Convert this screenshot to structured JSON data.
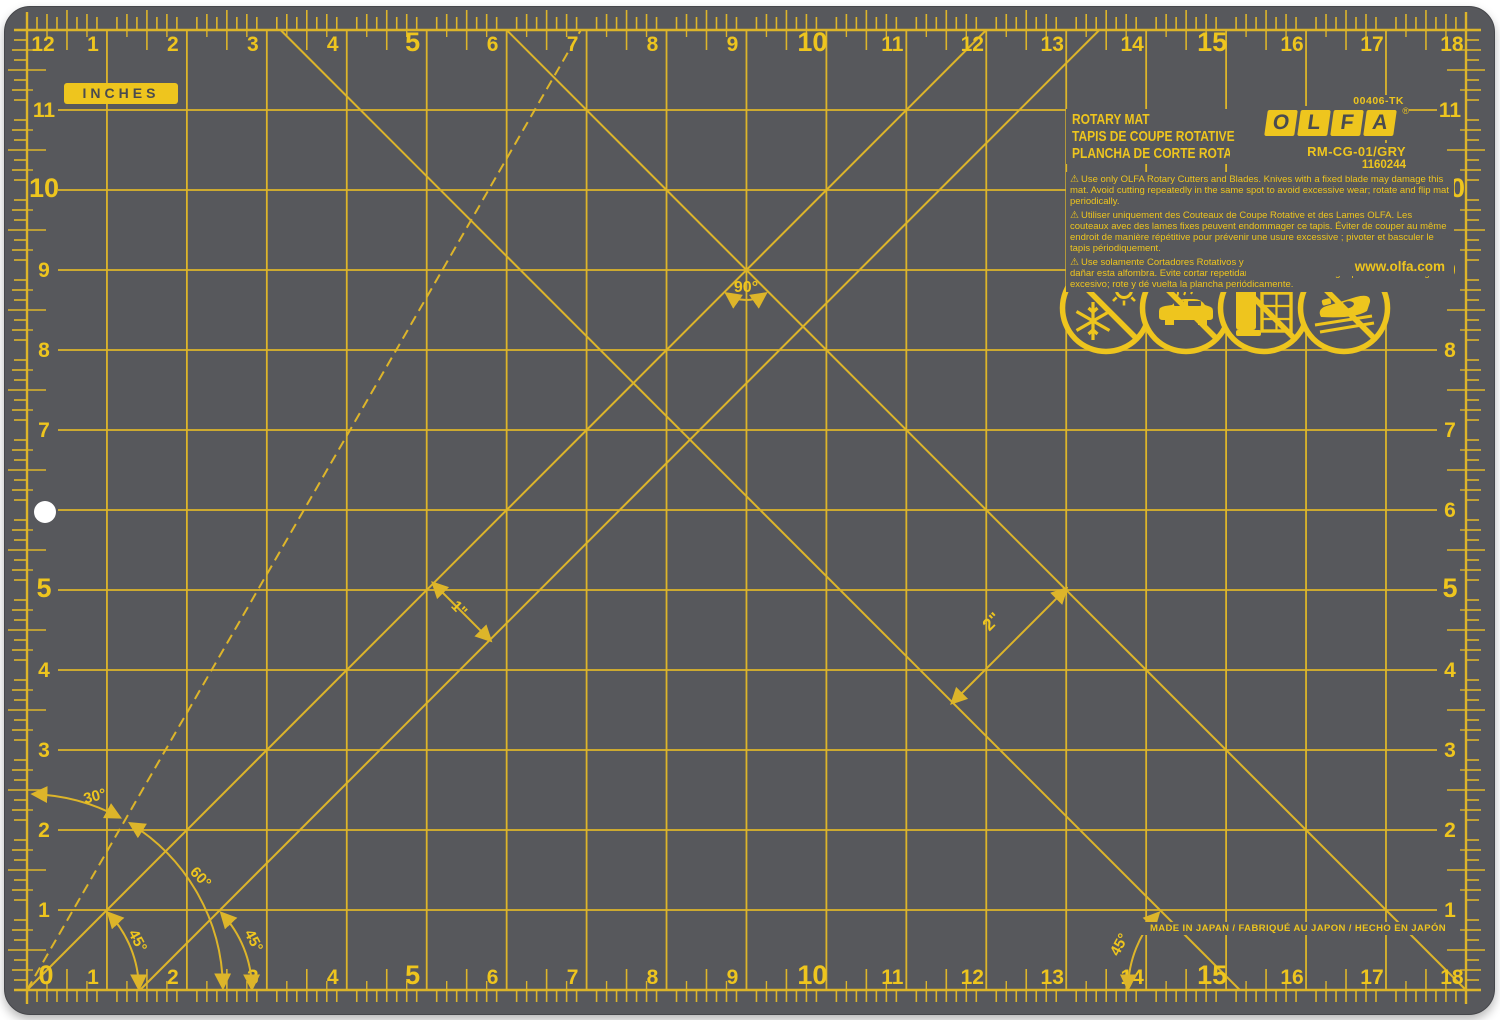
{
  "colors": {
    "mat": "#57585c",
    "line": "#ddb52a",
    "number": "#eec51e",
    "bright": "#f2ce1b",
    "dark": "#4a4b4f",
    "page": "#ffffff"
  },
  "badge": {
    "label": "INCHES"
  },
  "branding": {
    "part_code": "00406-TK",
    "title_en": "ROTARY MAT",
    "title_fr": "TAPIS DE COUPE ROTATIVE",
    "title_es": "PLANCHA DE CORTE ROTATIVA",
    "logo_letters": [
      "O",
      "L",
      "F",
      "A"
    ],
    "registered": "®",
    "model_code": "RM-CG-01/GRY",
    "item_number": "1160244",
    "website": "www.olfa.com",
    "made_in": "MADE IN JAPAN / FABRIQUÉ AU JAPON / HECHO EN JAPÓN"
  },
  "warnings": {
    "symbol": "⚠",
    "en": "Use only OLFA Rotary Cutters and Blades. Knives with a fixed blade may damage this mat. Avoid cutting repeatedly in the same spot to avoid excessive wear; rotate and flip mat periodically.",
    "fr": "Utiliser uniquement des Couteaux de Coupe Rotative et des Lames OLFA. Les couteaux avec des lames fixes peuvent endommager ce tapis. Éviter de couper au même endroit de manière répétitive pour prévenir une usure excessive ; pivoter et basculer le tapis périodiquement.",
    "es": "Use solamente Cortadores Rotativos y Hojas OLFA. Cuchillos con hojas fijas podrían dañar esta alfombra. Evite cortar repetidamente en el mismo lugar para evitar el desgaste excesivo; rote y dé vuelta la plancha periódicamente."
  },
  "angles": {
    "a90": "90°",
    "a30": "30°",
    "a60": "60°",
    "a45_left_inner": "45°",
    "a45_left_outer": "45°",
    "a45_right": "45°"
  },
  "dimensions": {
    "one_inch": "1\"",
    "two_inch": "2\""
  },
  "grid": {
    "x0": 27,
    "dx": 79.94,
    "y0": 990,
    "dy": 80,
    "unit": "inch",
    "cols": 18,
    "rows": 12
  },
  "hole": {
    "cx": 45,
    "cy": 512,
    "r": 11
  },
  "diagonals": [
    {
      "name": "diagonal-45-rising",
      "from": [
        0,
        0
      ],
      "to": [
        12,
        12
      ],
      "dashed": false
    },
    {
      "name": "diagonal-45-rising-offset-1in",
      "from": [
        1.414,
        0
      ],
      "to": [
        13.414,
        12
      ],
      "dashed": false
    },
    {
      "name": "diagonal-45-falling",
      "from": [
        6,
        12
      ],
      "to": [
        18,
        0
      ],
      "dashed": false
    },
    {
      "name": "diagonal-45-falling-offset-2in",
      "from": [
        3.172,
        12
      ],
      "to": [
        15.172,
        0
      ],
      "dashed": false
    },
    {
      "name": "diagonal-60-dashed",
      "from": [
        0,
        0
      ],
      "to": [
        6.928,
        12
      ],
      "dashed": true
    }
  ],
  "rulers": {
    "top": [
      {
        "label": "12",
        "inch": 0
      },
      {
        "label": "1",
        "inch": 1
      },
      {
        "label": "2",
        "inch": 2
      },
      {
        "label": "3",
        "inch": 3
      },
      {
        "label": "4",
        "inch": 4
      },
      {
        "label": "5",
        "inch": 5,
        "major": true
      },
      {
        "label": "6",
        "inch": 6
      },
      {
        "label": "7",
        "inch": 7
      },
      {
        "label": "8",
        "inch": 8
      },
      {
        "label": "9",
        "inch": 9
      },
      {
        "label": "10",
        "inch": 10,
        "major": true
      },
      {
        "label": "11",
        "inch": 11
      },
      {
        "label": "12",
        "inch": 12
      },
      {
        "label": "13",
        "inch": 13
      },
      {
        "label": "14",
        "inch": 14
      },
      {
        "label": "15",
        "inch": 15,
        "major": true
      },
      {
        "label": "16",
        "inch": 16
      },
      {
        "label": "17",
        "inch": 17
      },
      {
        "label": "18",
        "inch": 18
      }
    ],
    "bottom": [
      {
        "label": "0",
        "inch": 0,
        "major": true
      },
      {
        "label": "1",
        "inch": 1
      },
      {
        "label": "2",
        "inch": 2
      },
      {
        "label": "3",
        "inch": 3
      },
      {
        "label": "4",
        "inch": 4
      },
      {
        "label": "5",
        "inch": 5,
        "major": true
      },
      {
        "label": "6",
        "inch": 6
      },
      {
        "label": "7",
        "inch": 7
      },
      {
        "label": "8",
        "inch": 8
      },
      {
        "label": "9",
        "inch": 9
      },
      {
        "label": "10",
        "inch": 10,
        "major": true
      },
      {
        "label": "11",
        "inch": 11
      },
      {
        "label": "12",
        "inch": 12
      },
      {
        "label": "13",
        "inch": 13
      },
      {
        "label": "14",
        "inch": 14
      },
      {
        "label": "15",
        "inch": 15,
        "major": true
      },
      {
        "label": "16",
        "inch": 16
      },
      {
        "label": "17",
        "inch": 17
      },
      {
        "label": "18",
        "inch": 18
      }
    ],
    "left": [
      {
        "label": "11",
        "inch": 11
      },
      {
        "label": "10",
        "inch": 10,
        "major": true
      },
      {
        "label": "9",
        "inch": 9
      },
      {
        "label": "8",
        "inch": 8
      },
      {
        "label": "7",
        "inch": 7
      },
      {
        "label": "5",
        "inch": 5,
        "major": true
      },
      {
        "label": "4",
        "inch": 4
      },
      {
        "label": "3",
        "inch": 3
      },
      {
        "label": "2",
        "inch": 2
      },
      {
        "label": "1",
        "inch": 1
      }
    ],
    "right": [
      {
        "label": "11",
        "inch": 11
      },
      {
        "label": "10",
        "inch": 10,
        "major": true
      },
      {
        "label": "9",
        "inch": 9
      },
      {
        "label": "8",
        "inch": 8
      },
      {
        "label": "7",
        "inch": 7
      },
      {
        "label": "6",
        "inch": 6
      },
      {
        "label": "5",
        "inch": 5,
        "major": true
      },
      {
        "label": "4",
        "inch": 4
      },
      {
        "label": "3",
        "inch": 3
      },
      {
        "label": "2",
        "inch": 2
      },
      {
        "label": "1",
        "inch": 1
      }
    ]
  },
  "icons": [
    {
      "name": "no-temperature-extremes-icon"
    },
    {
      "name": "no-hot-car-icon"
    },
    {
      "name": "no-lean-storage-icon"
    },
    {
      "name": "no-iron-icon"
    }
  ]
}
